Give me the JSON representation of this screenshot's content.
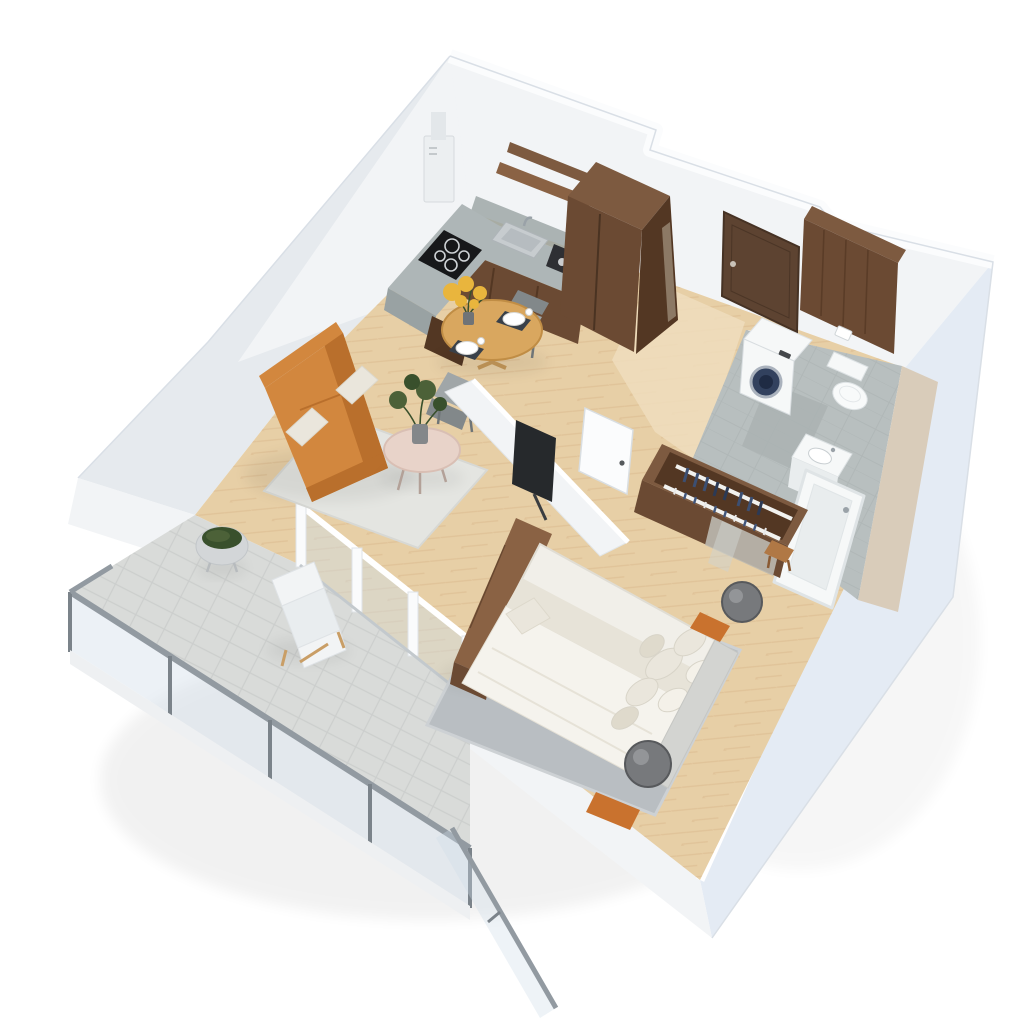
{
  "scene": {
    "type": "3d-isometric-floor-plan-render",
    "view": "top-down axonometric, apartment rotated with top wall to upper-right",
    "background": "#ffffff"
  },
  "colors": {
    "bg": "#ffffff",
    "wallFace": "#f2f4f6",
    "wallFaceShade": "#e6eaee",
    "wallTop": "#fbfcfd",
    "wallOuterBlue": "#e4ebf4",
    "wallEdge": "#d9dfe6",
    "woodFloor": "#e7cfa6",
    "woodFloorLight": "#efddbd",
    "woodLine": "#d9b88b",
    "balconyTile": "#d9dbd9",
    "balconyTileLine": "#c7cac8",
    "bathTile": "#b8bfbf",
    "bathTileLine": "#a9b0b0",
    "bathWallBeige": "#d9ccba",
    "darkWood": "#6b4a33",
    "darkWoodDeep": "#533723",
    "darkWoodTop": "#7d5a40",
    "woodMid": "#8a6244",
    "stone": "#aeb6b7",
    "stoneDark": "#99a2a3",
    "sofa": "#d2873e",
    "sofaDeep": "#b96f2c",
    "rugLiving": "#e4e5e1",
    "rugBed": "#b9bec2",
    "rugBedEdge": "#cdd1d4",
    "linen": "#f1efe9",
    "linenShade": "#e7e3d8",
    "pillow": "#eae6dc",
    "headboard": "#d3d4d1",
    "lamp": "#77797c",
    "lampDark": "#57595c",
    "plant": "#4c6138",
    "plantDark": "#39502c",
    "flowers": "#e9b53d",
    "tableWood": "#d9a75f",
    "tableWoodEdge": "#c08d45",
    "chair": "#a0a6a8",
    "chairDark": "#82888a",
    "coffeeTableTop": "#e8d3c9",
    "tv": "#26292c",
    "applianceWhite": "#f6f8f8",
    "applianceEdge": "#d8dde0",
    "wmDoor": "#32415e",
    "wmDoorDeep": "#1f2b44",
    "doorBrown": "#5d4331",
    "doorBrownDeep": "#463224",
    "glass": "#cfdde8",
    "metal": "#929aa1",
    "metalDark": "#7b838a",
    "stoolWood": "#b07845",
    "accentOrange": "#c9722e"
  },
  "rooms": [
    {
      "name": "kitchen",
      "items": [
        "stone-countertop",
        "induction-cooktop",
        "range-hood",
        "kitchen-sink",
        "coffee-machine",
        "dark-wood-base-cabinets",
        "wood-wall-shelves",
        "tall-wood-cabinet"
      ]
    },
    {
      "name": "dining-area",
      "items": [
        "round-wood-table",
        "yellow-bouquet",
        "place-settings",
        "two-gray-chairs"
      ]
    },
    {
      "name": "living-room",
      "items": [
        "orange-sofa",
        "white-cushions",
        "round-coffee-table",
        "green-plant",
        "gray-area-rug",
        "tv-partition-wall",
        "flat-screen-tv",
        "balcony-glass-doors"
      ]
    },
    {
      "name": "hallway",
      "items": [
        "entry-door-dark-brown",
        "white-interior-door",
        "herringbone-wood-floor"
      ]
    },
    {
      "name": "bathroom",
      "items": [
        "dark-wood-accent-wall",
        "washing-machine",
        "wall-hung-toilet",
        "vanity-sink",
        "bathtub",
        "gray-tile-floor",
        "beige-wall-panel"
      ]
    },
    {
      "name": "bedroom",
      "items": [
        "double-bed-white-bedding",
        "pillow-cluster",
        "gray-headboard",
        "two-sphere-lamps",
        "wood-bench",
        "open-wardrobe-with-clothes",
        "wood-stool",
        "gray-rug",
        "orange-accents"
      ]
    },
    {
      "name": "balcony",
      "items": [
        "glass-railing",
        "metal-posts",
        "lounge-chair",
        "round-moss-planter",
        "stone-tile-floor"
      ]
    }
  ]
}
